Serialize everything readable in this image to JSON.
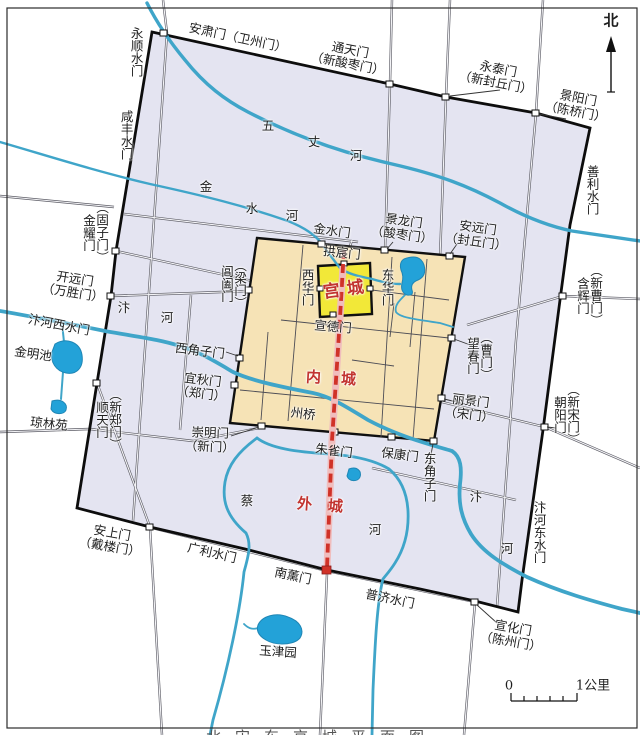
{
  "compass": {
    "north": "北"
  },
  "scale_bar": {
    "zero": "0",
    "one_km": "1公里"
  },
  "regions": {
    "palace": "宫城",
    "inner_city": "内城",
    "outer_city": "外城"
  },
  "rivers": {
    "wuzhanghe": [
      "五",
      "丈",
      "河"
    ],
    "jinshuihe": [
      "金",
      "水",
      "河"
    ],
    "bianhe_west": [
      "汴",
      "河"
    ],
    "bianhe_east": [
      "汴",
      "河"
    ],
    "caihe": [
      "蔡",
      "河"
    ]
  },
  "water_gates": {
    "yongshun": "永顺水门",
    "xianfeng": "咸丰水门",
    "bianhe_xi": "汴河西水门",
    "guangli": "广利水门",
    "puji": "普济水门",
    "shanli": "善利水门",
    "bianhe_dong": "汴河东水门"
  },
  "outer_gates": {
    "ansu": "安肃门（卫州门）",
    "tongtian": "通天门\n（新酸枣门）",
    "yongtai": "永泰门\n（新封丘门）",
    "jingyang": "景阳门\n（陈桥门）",
    "jinyao": "金耀门\n（固子门）",
    "kaiyuan": "开远门\n（万胜门）",
    "shuntian": "顺天门\n（新郑门）",
    "anshang": "安上门\n（戴楼门）",
    "nanxun": "南薰门",
    "xuanhua": "宣化门\n（陈州门）",
    "hanhui": "含辉门\n（新曹门）",
    "chaoyang": "朝阳门\n（新宋门）"
  },
  "inner_gates": {
    "jinglong": "景龙门\n（酸枣门）",
    "anyuan": "安远门\n（封丘门）",
    "jinshui": "金水门",
    "changhe": "阊阖门\n（梁门）",
    "xijiaozi": "西角子门",
    "yiqiu": "宜秋门\n（郑门）",
    "chongming": "崇明门\n（新门）",
    "zhuque": "朱雀门",
    "baokang": "保康门",
    "dongjiaozi": "东角子门",
    "wangchun": "望春门\n（曹门）",
    "lijing": "丽景门\n（宋门）"
  },
  "palace_gates": {
    "gongchen": "拱宸门",
    "xihua": "西华门",
    "donghua": "东华门",
    "xuande": "宣德门"
  },
  "landmarks": {
    "jinmingchi": "金明池",
    "qionglinyuan": "琼林苑",
    "yujinyuan": "玉津园",
    "zhouqiao": "州桥"
  },
  "caption_partial": "北宋东京城平面图",
  "colors": {
    "outer_city_fill": "#e4e4f1",
    "inner_city_fill": "#f6e3b6",
    "palace_fill": "#f2e838",
    "river": "#3fa5c9",
    "lake": "#23a2d8",
    "imperial_street_red": "#d03228",
    "imperial_street_pink": "#f0bdbd",
    "region_label_red": "#c23430"
  }
}
